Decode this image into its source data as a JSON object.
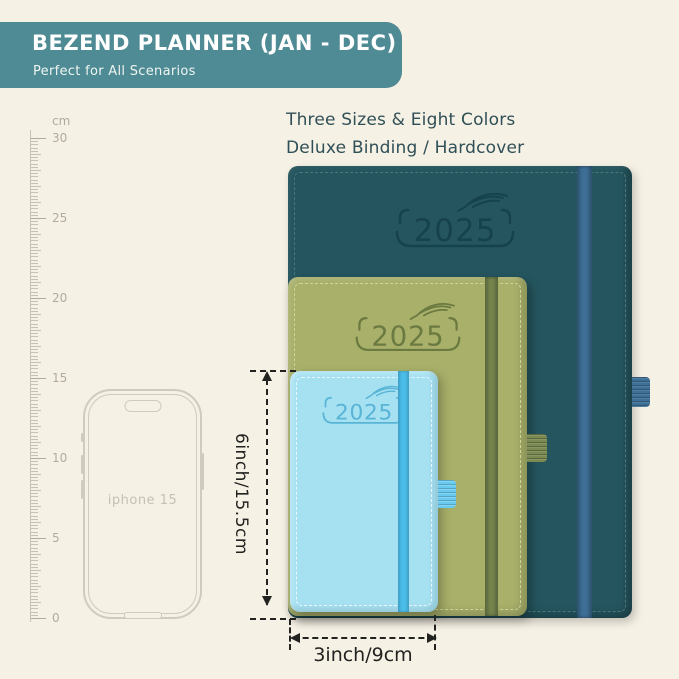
{
  "banner": {
    "title": "BEZEND PLANNER (JAN - DEC)",
    "subtitle": "Perfect for All Scenarios"
  },
  "headline": {
    "line1": "Three Sizes & Eight Colors",
    "line2": "Deluxe Binding / Hardcover"
  },
  "ruler": {
    "unit": "cm",
    "max_cm": 30,
    "px_per_cm": 16,
    "origin_px": 504,
    "labels": [
      {
        "cm": 30,
        "text": "30"
      },
      {
        "cm": 25,
        "text": "25"
      },
      {
        "cm": 20,
        "text": "20"
      },
      {
        "cm": 15,
        "text": "15"
      },
      {
        "cm": 10,
        "text": "10"
      },
      {
        "cm": 5,
        "text": "5"
      },
      {
        "cm": 0,
        "text": "0"
      }
    ]
  },
  "phone": {
    "label": "iphone 15"
  },
  "notebooks": [
    {
      "id": "large-dark-teal",
      "year": "2025"
    },
    {
      "id": "medium-olive-green",
      "year": "2025"
    },
    {
      "id": "small-light-blue",
      "year": "2025"
    }
  ],
  "dimensions": {
    "height_label": "6inch/15.5cm",
    "width_label": "3inch/9cm"
  },
  "colors": {
    "bg": "#f6f1e5",
    "banner-bg": "#4e8b94",
    "banner-text": "#ffffff",
    "headline-text": "#2f4f57",
    "ruler-tick": "#c8c2b4",
    "ruler-label": "#b2ab9d",
    "phone-line": "#cfcbc0",
    "phone-text": "#c5c1b5",
    "teal-cover": "#25565f",
    "teal-stitch": "#4b767e",
    "teal-logo": "#16424d",
    "teal-band": "#3e6f96",
    "olive-cover": "#a8b06a",
    "olive-stitch": "#ccd49a",
    "olive-logo": "#6b7a40",
    "olive-band": "#75854e",
    "olive-loop": "#7b8a53",
    "blue-cover": "#a6e1f2",
    "blue-stitch": "#e9f8fd",
    "blue-logo": "#58b4d6",
    "blue-band": "#4cbce9",
    "blue-loop": "#68caef",
    "dim-color": "#222220"
  }
}
